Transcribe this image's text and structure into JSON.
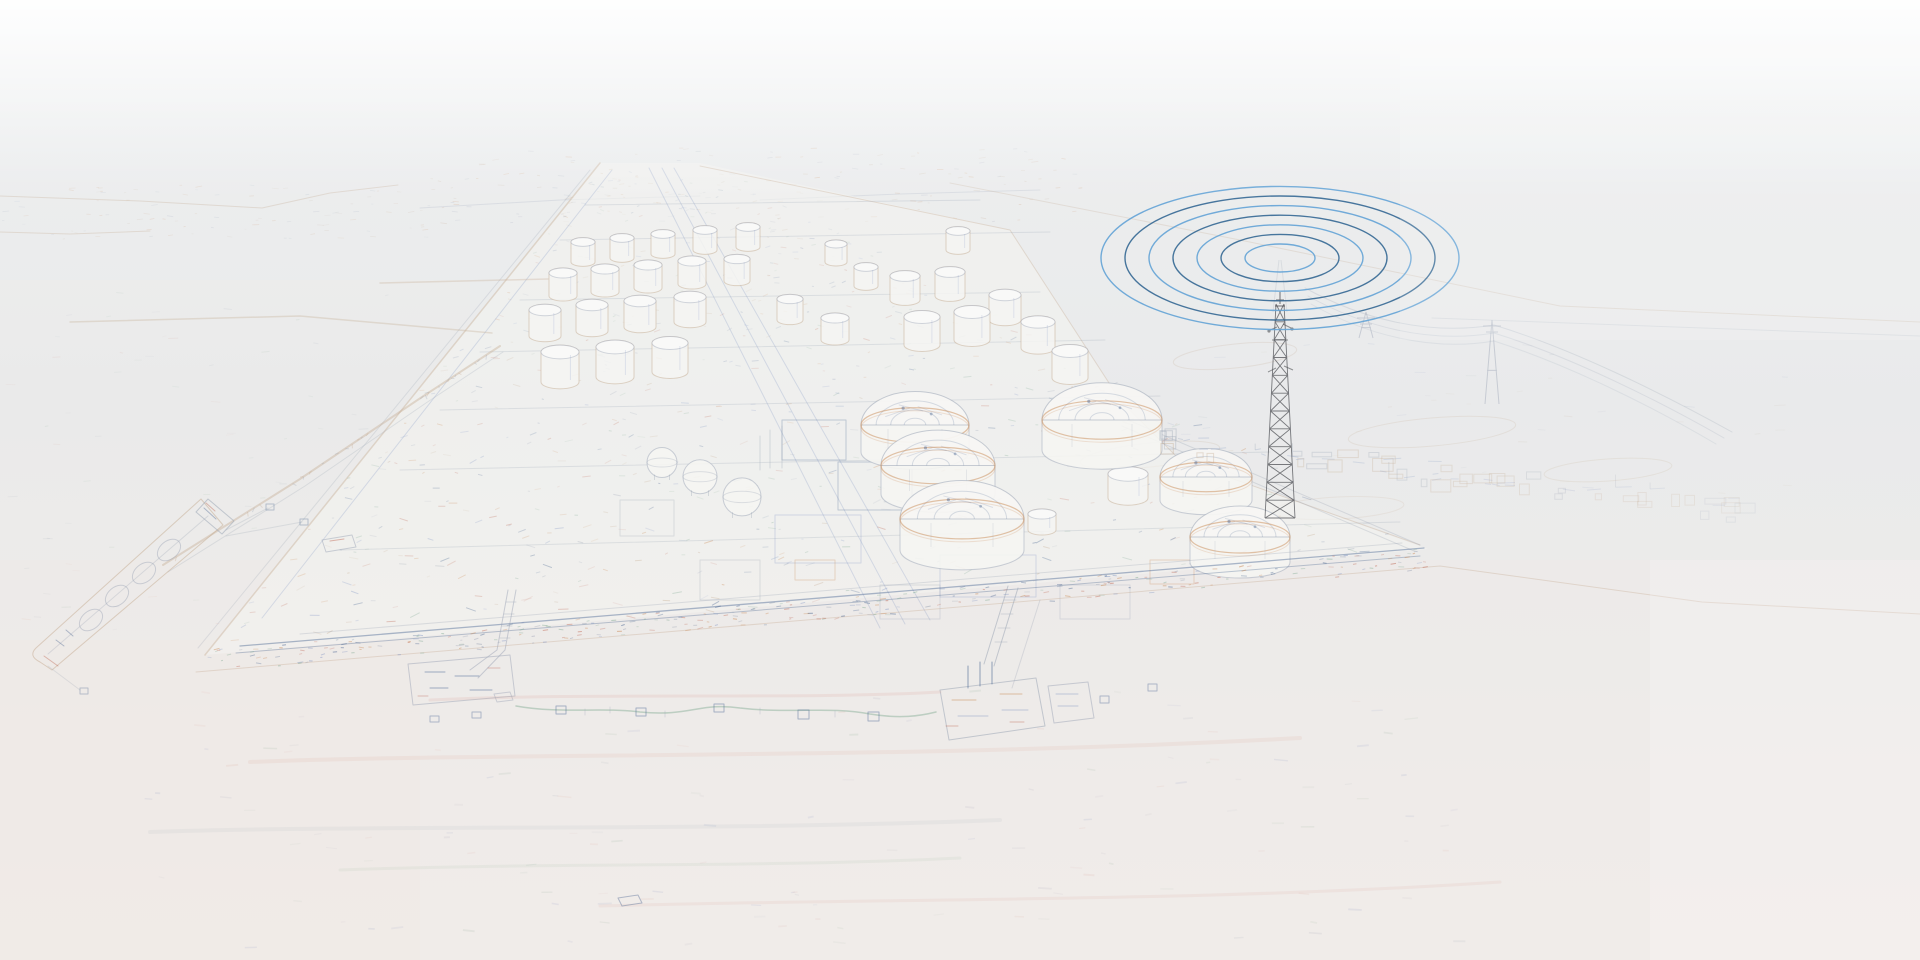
{
  "canvas": {
    "width": 1920,
    "height": 960
  },
  "palette": {
    "background_top": "#edeff0",
    "background_mid": "#e8e9ea",
    "background_low": "#ecebe9",
    "background_bottom": "#f1ede9",
    "water_tint": "#efe9e5",
    "plant_ground": "#f4f4f1",
    "tank_fill": "#f5f5f2",
    "platform_fill": "#f1f0ed",
    "sketch_gray": "#98a2b3",
    "sketch_tan": "#c2a78b",
    "sketch_orange": "#c8854e",
    "sketch_blue": "#7d92c2",
    "sketch_navy": "#42608d",
    "sketch_green": "#85ad96",
    "sketch_red": "#bf6a57",
    "sketch_pink": "#d8a095",
    "tower_line": "#46474c",
    "wave_blue_light": "#5b9fd4",
    "wave_blue_dark": "#2a608e"
  },
  "radio_waves": {
    "center_x": 1280,
    "center_y": 258,
    "ring_count": 7,
    "inner_semi_major": 35,
    "ring_gap": 24,
    "vertical_ratio": 0.4,
    "stroke_width": 1.4
  },
  "telecom_tower": {
    "x": 1280,
    "top_y": 304,
    "base_y": 518,
    "half_width_base": 15,
    "half_width_top": 4,
    "segments": 12
  },
  "power_pylons": [
    {
      "x": 1366,
      "base_y": 338,
      "height": 26
    },
    {
      "x": 1492,
      "base_y": 404,
      "height": 84
    }
  ],
  "small_tanks": [
    {
      "x": 583,
      "y": 262,
      "r": 12,
      "h": 20
    },
    {
      "x": 622,
      "y": 258,
      "r": 12,
      "h": 20
    },
    {
      "x": 663,
      "y": 254,
      "r": 12,
      "h": 20
    },
    {
      "x": 705,
      "y": 250,
      "r": 12,
      "h": 20
    },
    {
      "x": 748,
      "y": 247,
      "r": 12,
      "h": 20
    },
    {
      "x": 563,
      "y": 296,
      "r": 14,
      "h": 23
    },
    {
      "x": 605,
      "y": 292,
      "r": 14,
      "h": 23
    },
    {
      "x": 648,
      "y": 288,
      "r": 14,
      "h": 23
    },
    {
      "x": 692,
      "y": 284,
      "r": 14,
      "h": 23
    },
    {
      "x": 737,
      "y": 281,
      "r": 13,
      "h": 22
    },
    {
      "x": 545,
      "y": 336,
      "r": 16,
      "h": 26
    },
    {
      "x": 592,
      "y": 331,
      "r": 16,
      "h": 26
    },
    {
      "x": 640,
      "y": 327,
      "r": 16,
      "h": 26
    },
    {
      "x": 690,
      "y": 322,
      "r": 16,
      "h": 25
    },
    {
      "x": 560,
      "y": 382,
      "r": 19,
      "h": 30
    },
    {
      "x": 615,
      "y": 377,
      "r": 19,
      "h": 30
    },
    {
      "x": 670,
      "y": 372,
      "r": 18,
      "h": 29
    },
    {
      "x": 836,
      "y": 262,
      "r": 11,
      "h": 18
    },
    {
      "x": 866,
      "y": 286,
      "r": 12,
      "h": 19
    },
    {
      "x": 958,
      "y": 250,
      "r": 12,
      "h": 19
    },
    {
      "x": 905,
      "y": 300,
      "r": 15,
      "h": 24
    },
    {
      "x": 950,
      "y": 296,
      "r": 15,
      "h": 24
    },
    {
      "x": 790,
      "y": 320,
      "r": 13,
      "h": 21
    },
    {
      "x": 835,
      "y": 340,
      "r": 14,
      "h": 22
    },
    {
      "x": 922,
      "y": 345,
      "r": 18,
      "h": 28
    },
    {
      "x": 972,
      "y": 340,
      "r": 18,
      "h": 28
    },
    {
      "x": 1005,
      "y": 320,
      "r": 16,
      "h": 25
    },
    {
      "x": 1038,
      "y": 348,
      "r": 17,
      "h": 26
    },
    {
      "x": 1070,
      "y": 378,
      "r": 18,
      "h": 27
    },
    {
      "x": 1128,
      "y": 498,
      "r": 20,
      "h": 24
    },
    {
      "x": 1042,
      "y": 530,
      "r": 14,
      "h": 16
    }
  ],
  "dome_tanks": [
    {
      "x": 915,
      "y": 452,
      "r": 54
    },
    {
      "x": 938,
      "y": 494,
      "r": 57
    },
    {
      "x": 962,
      "y": 550,
      "r": 62
    },
    {
      "x": 1102,
      "y": 450,
      "r": 60
    },
    {
      "x": 1206,
      "y": 500,
      "r": 46
    },
    {
      "x": 1240,
      "y": 562,
      "r": 50
    }
  ],
  "sphere_tanks": [
    {
      "x": 662,
      "y": 476,
      "r": 15
    },
    {
      "x": 700,
      "y": 492,
      "r": 17
    },
    {
      "x": 742,
      "y": 514,
      "r": 19
    }
  ]
}
